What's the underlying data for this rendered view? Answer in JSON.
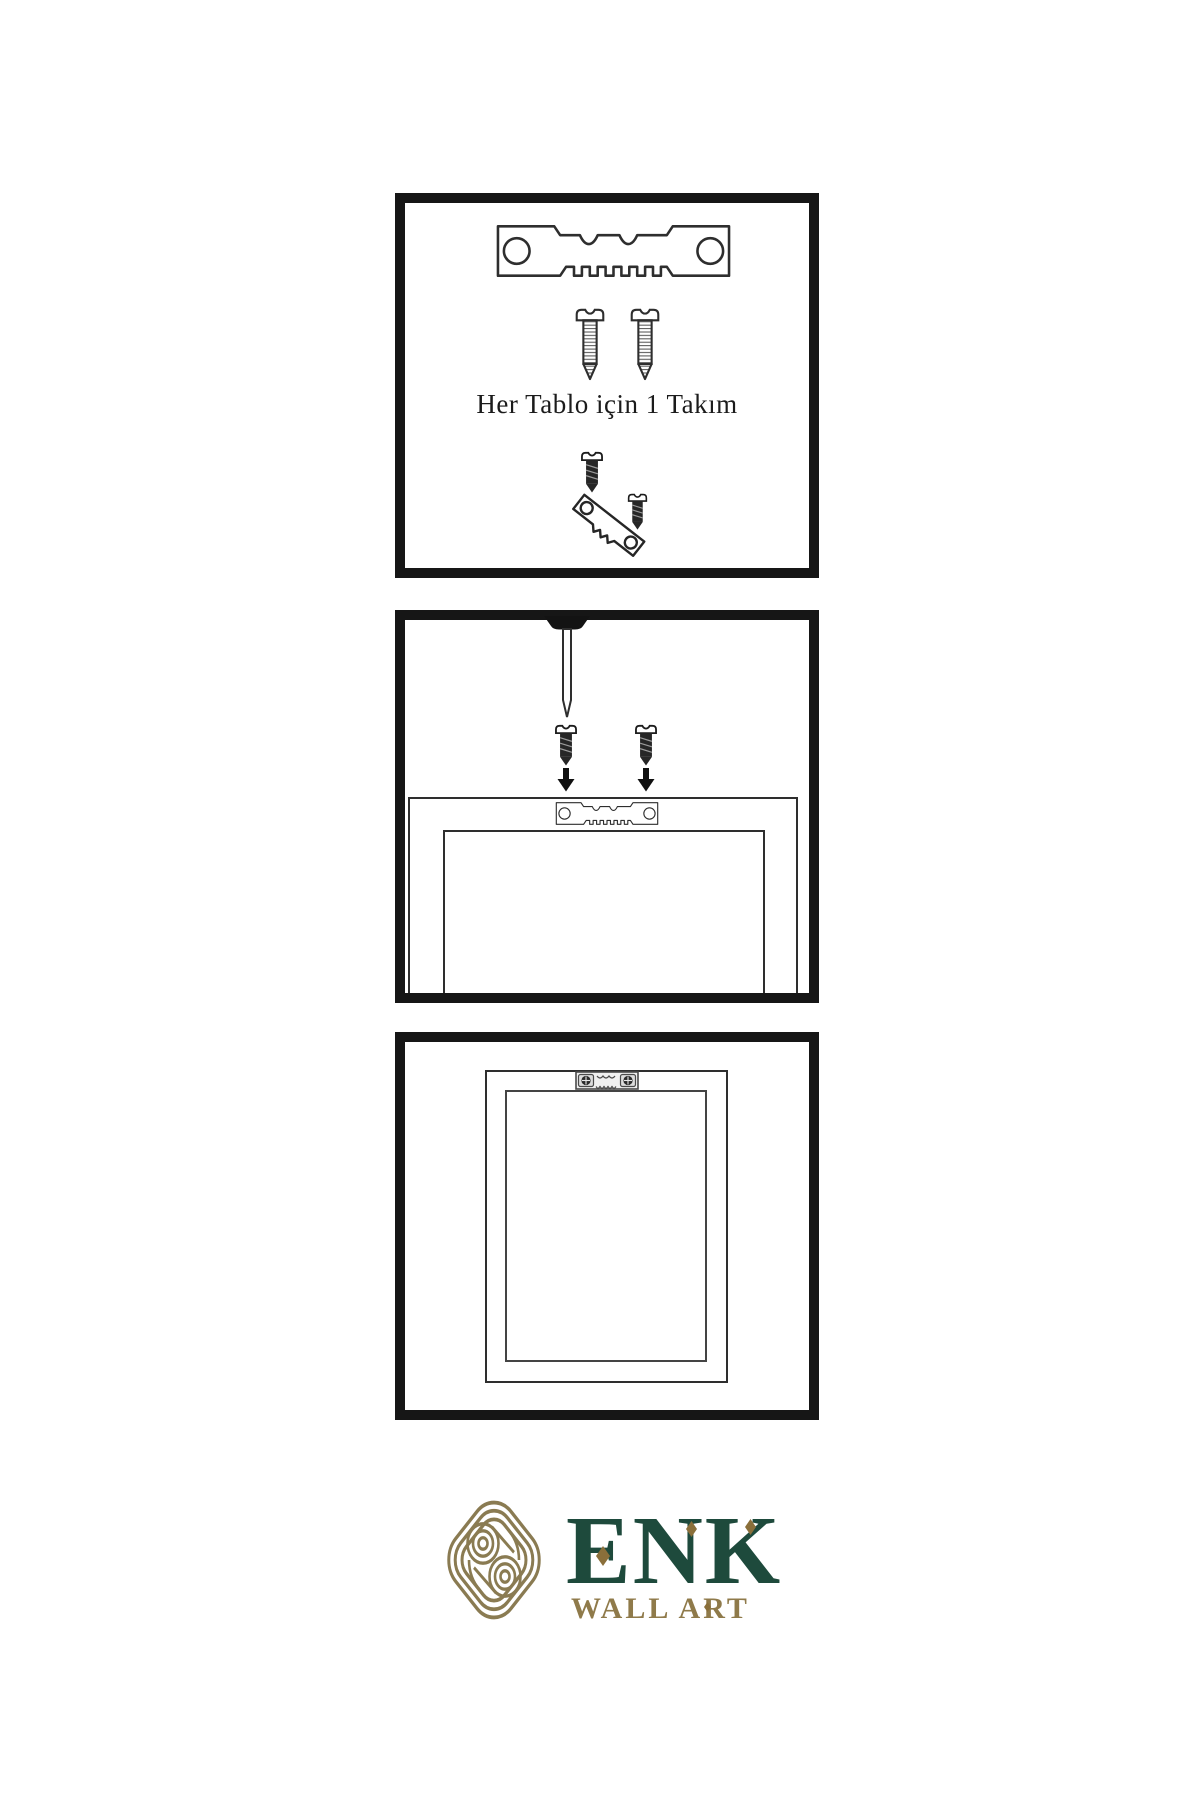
{
  "page": {
    "background": "#ffffff",
    "type": "wall-art hanging instruction sheet"
  },
  "steps": [
    {
      "id": 1,
      "caption": "Her Tablo için 1 Takım",
      "icons": [
        "sawtooth-hanger-icon",
        "screw-icon",
        "screw-icon",
        "dark-screw-icon",
        "tilted-sawtooth-hanger-icon",
        "dark-screw-icon"
      ]
    },
    {
      "id": 2,
      "icons": [
        "wall-nail-icon",
        "dark-screw-icon",
        "dark-screw-icon",
        "arrow-down-icon",
        "arrow-down-icon",
        "sawtooth-hanger-icon",
        "frame-back-outline"
      ]
    },
    {
      "id": 3,
      "icons": [
        "mounted-sawtooth-hanger-icon",
        "frame-front-outline"
      ]
    }
  ],
  "logo": {
    "brand": "ENK",
    "subtitle": "WALL ART",
    "icon": "interlocked-knot-icon"
  },
  "colors": {
    "ink": "#161616",
    "line_art": "#2e2e2e",
    "brand_green": "#1e4a3c",
    "brand_gold": "#8f7a4a",
    "diamond_gold": "#8a6f3a",
    "knot_gold": "#8a7b52"
  }
}
